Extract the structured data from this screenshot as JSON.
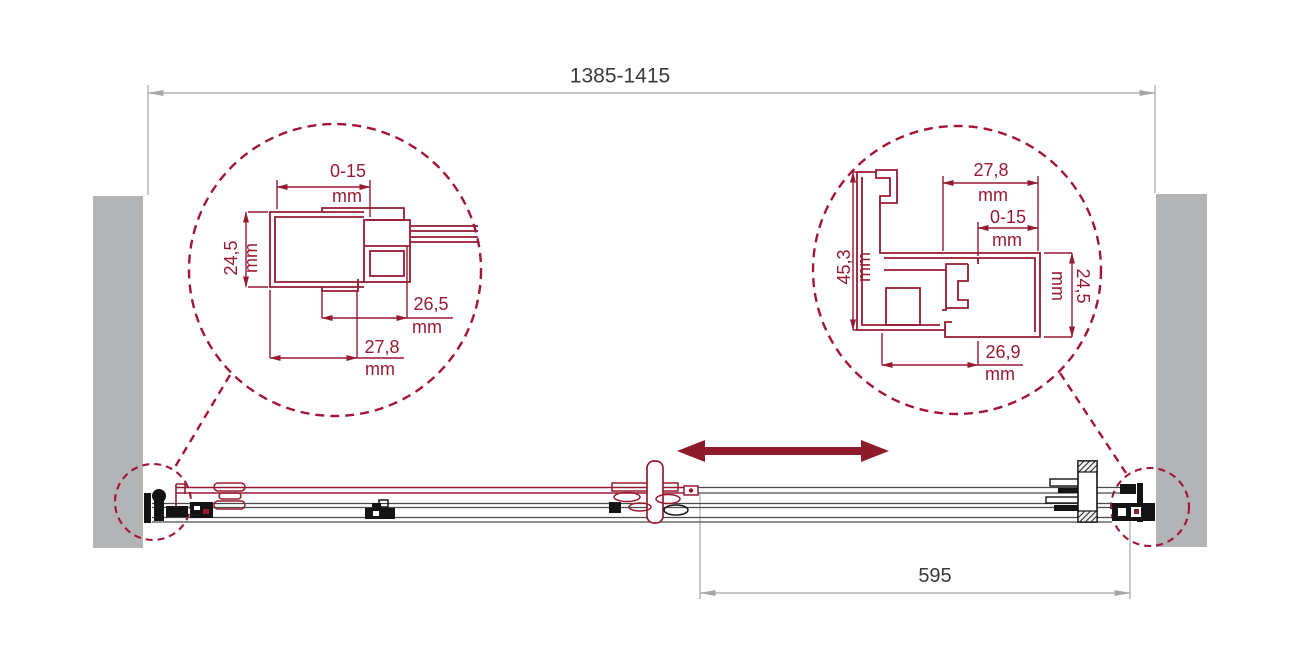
{
  "drawing": {
    "title_hint": "sliding shower door installation diagram",
    "unit": "mm",
    "overall_width_label": "1385-1415",
    "travel_label": "595",
    "left_detail": {
      "top_value": "0-15",
      "height_value": "24,5",
      "inner_width_value": "26,5",
      "outer_width_value": "27,8"
    },
    "right_detail": {
      "top_width_value": "27,8",
      "adjust_value": "0-15",
      "height_value": "45,3",
      "side_height_value": "24,5",
      "bottom_width_value": "26,9"
    },
    "colors": {
      "profile_red": "#971a33",
      "dashed_circle_red": "#a31538",
      "slide_arrow_red": "#8e1b2b",
      "dimension_gray": "#b2b2b2",
      "wall_gray": "#b3b4b6",
      "text_dark": "#3a3a3a",
      "hardware_black": "#141414"
    }
  }
}
